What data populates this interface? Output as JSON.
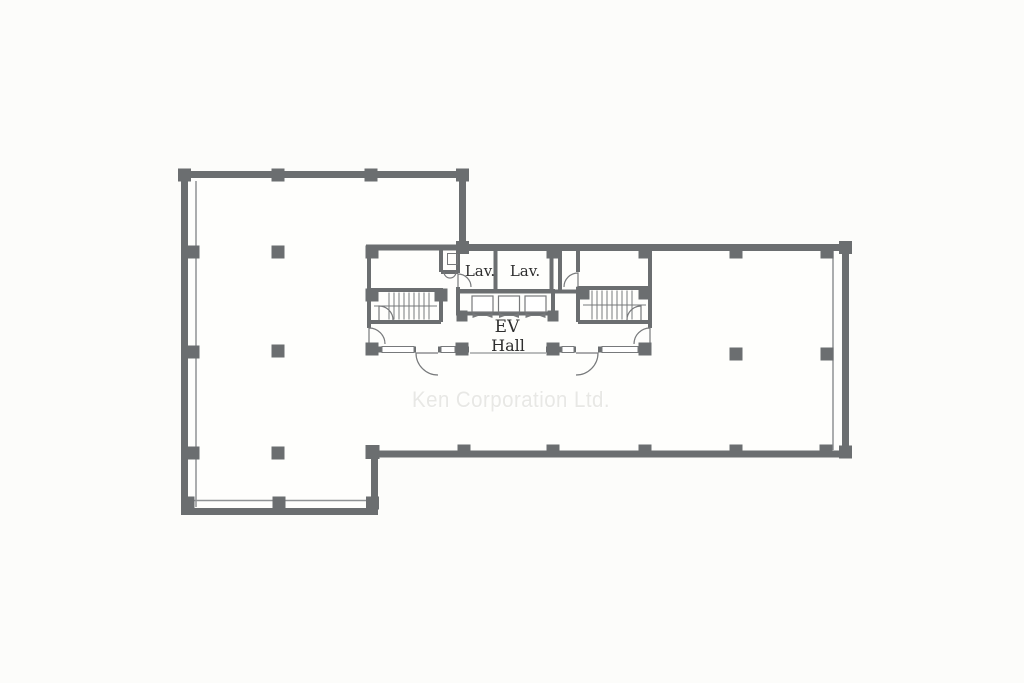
{
  "watermark": "Ken Corporation Ltd.",
  "rooms": {
    "lavatory_left": "Lav.",
    "lavatory_right": "Lav.",
    "elevator_hall_line1": "EV",
    "elevator_hall_line2": "Hall"
  },
  "colors": {
    "background": "#fcfcfa",
    "floor": "#fefefc",
    "wall": "#6b6e70",
    "window_line": "#8f9294",
    "thin_line": "#77797b",
    "label": "#2e2e2e",
    "watermark": "#e8e8e5"
  }
}
